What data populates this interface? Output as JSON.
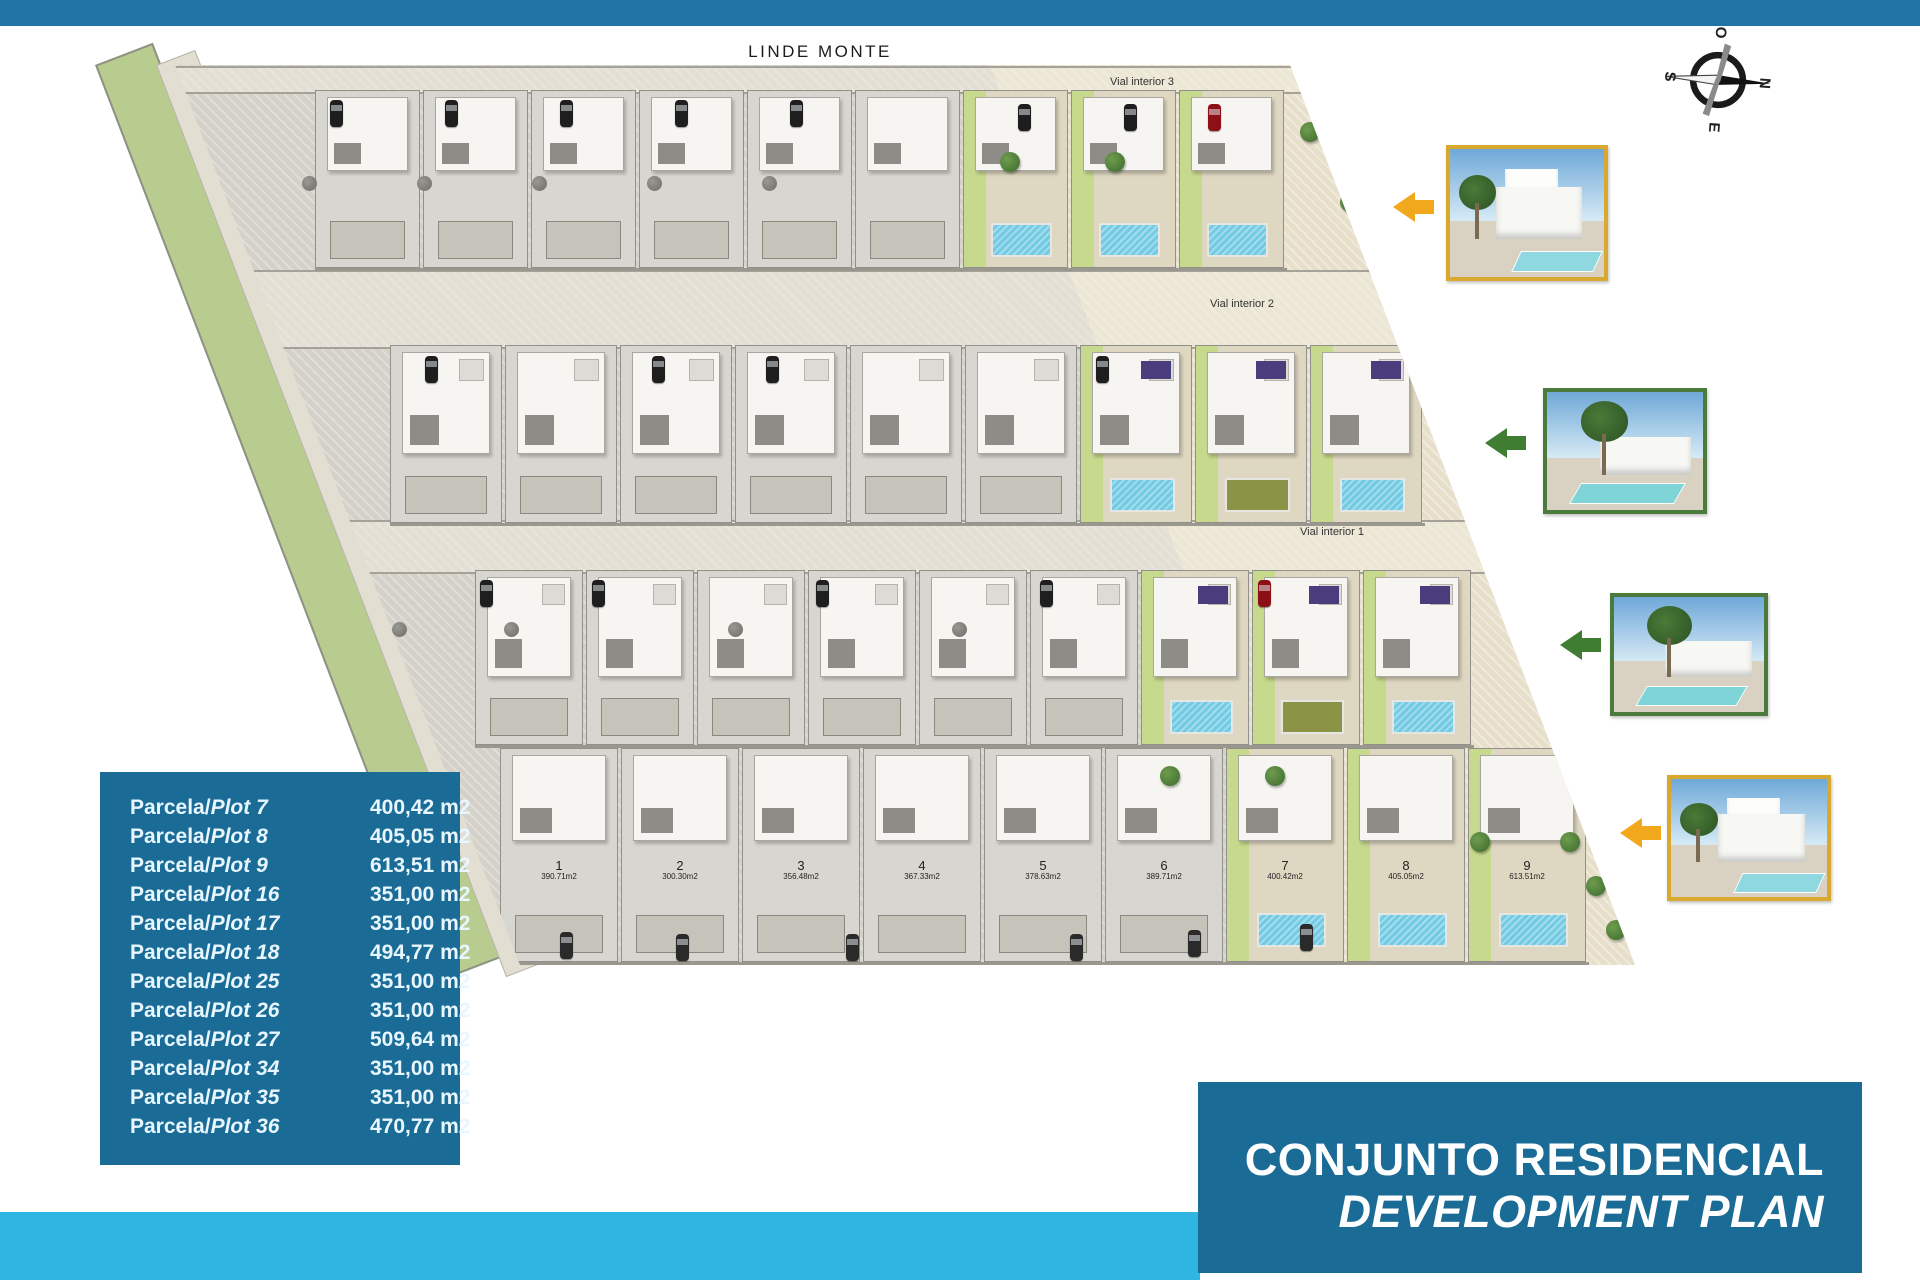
{
  "street_label": "LINDE MONTE",
  "compass": {
    "n": "N",
    "e": "E",
    "s": "S",
    "o": "O"
  },
  "title_block": {
    "line1": "CONJUNTO RESIDENCIAL",
    "line2": "DEVELOPMENT PLAN"
  },
  "colors": {
    "top_bar": "#2172a5",
    "cyan_bar": "#2eb5e2",
    "title_box": "#1a6b96",
    "legend_box": "#1a6b96",
    "parcel_gray": "#d4d1c9",
    "parcel_cream": "#e7dfca",
    "green_verge": "#b9cc90",
    "lawn_green": "#c7d98d",
    "pool_blue": "#72cbe3",
    "olive_lawn": "#8a9346",
    "solar_panel_purple": "#4a3d7e",
    "photo_frame_gold": "#d9a82e",
    "photo_frame_green": "#4b7a3d",
    "arrow_orange": "#f2a81d",
    "arrow_green": "#3f7d33",
    "car_red": "#8d1016",
    "car_black": "#1e1e1e"
  },
  "plan": {
    "roads": [
      {
        "label": "Vial interior 3"
      },
      {
        "label": "Vial interior 2"
      },
      {
        "label": "Vial interior 1"
      }
    ],
    "rows": [
      {
        "plots": [
          {
            "num": "28",
            "area": "371.97m2",
            "hi": false
          },
          {
            "num": "29",
            "area": "351.00m2",
            "hi": false
          },
          {
            "num": "30",
            "area": "351.00m2",
            "hi": false
          },
          {
            "num": "31",
            "area": "351.00m2",
            "hi": false
          },
          {
            "num": "32",
            "area": "351.00m2",
            "hi": false
          },
          {
            "num": "33",
            "area": "351.00m2",
            "hi": false
          },
          {
            "num": "34",
            "area": "351.00m2",
            "hi": true,
            "feature": "pool"
          },
          {
            "num": "35",
            "area": "351.00m2",
            "hi": true,
            "feature": "pool"
          },
          {
            "num": "36",
            "area": "470.77m2",
            "hi": true,
            "feature": "pool"
          }
        ]
      },
      {
        "plots": [
          {
            "num": "19",
            "area": "345.38m2",
            "hi": false
          },
          {
            "num": "20",
            "area": "351.00m2",
            "hi": false
          },
          {
            "num": "21",
            "area": "351.00m2",
            "hi": false
          },
          {
            "num": "22",
            "area": "351.00m2",
            "hi": false
          },
          {
            "num": "23",
            "area": "351.00m2",
            "hi": false
          },
          {
            "num": "24",
            "area": "351.00m2",
            "hi": false
          },
          {
            "num": "25",
            "area": "351.00m2",
            "hi": true,
            "feature": "pool"
          },
          {
            "num": "26",
            "area": "351.00m2",
            "hi": true,
            "feature": "olive"
          },
          {
            "num": "27",
            "area": "509.64m2",
            "hi": true,
            "feature": "pool"
          }
        ]
      },
      {
        "plots": [
          {
            "num": "10",
            "area": "349.69m2",
            "hi": false
          },
          {
            "num": "11",
            "area": "351.00m2",
            "hi": false
          },
          {
            "num": "12",
            "area": "351.00m2",
            "hi": false
          },
          {
            "num": "13",
            "area": "351.00m2",
            "hi": false
          },
          {
            "num": "14",
            "area": "351.00m2",
            "hi": false
          },
          {
            "num": "15",
            "area": "351.00m2",
            "hi": false
          },
          {
            "num": "16",
            "area": "351.00m2",
            "hi": true,
            "feature": "pool"
          },
          {
            "num": "17",
            "area": "351.00m2",
            "hi": true,
            "feature": "olive"
          },
          {
            "num": "18",
            "area": "494.77m2",
            "hi": true,
            "feature": "pool"
          }
        ]
      },
      {
        "plots": [
          {
            "num": "1",
            "area": "390.71m2",
            "hi": false
          },
          {
            "num": "2",
            "area": "300.30m2",
            "hi": false
          },
          {
            "num": "3",
            "area": "356.48m2",
            "hi": false
          },
          {
            "num": "4",
            "area": "367.33m2",
            "hi": false
          },
          {
            "num": "5",
            "area": "378.63m2",
            "hi": false
          },
          {
            "num": "6",
            "area": "389.71m2",
            "hi": false
          },
          {
            "num": "7",
            "area": "400.42m2",
            "hi": true,
            "feature": "pool"
          },
          {
            "num": "8",
            "area": "405.05m2",
            "hi": true,
            "feature": "pool"
          },
          {
            "num": "9",
            "area": "613.51m2",
            "hi": true,
            "feature": "pool"
          }
        ]
      }
    ],
    "decor": {
      "cars": [
        [
          240,
          40,
          "#1e1e1e"
        ],
        [
          355,
          40,
          "#1e1e1e"
        ],
        [
          470,
          40,
          "#1e1e1e"
        ],
        [
          585,
          40,
          "#1e1e1e"
        ],
        [
          700,
          40,
          "#1e1e1e"
        ],
        [
          928,
          44,
          "#1e1e1e"
        ],
        [
          1034,
          44,
          "#1e1e1e"
        ],
        [
          1118,
          44,
          "#8d1016"
        ],
        [
          335,
          296,
          "#1e1e1e"
        ],
        [
          562,
          296,
          "#1e1e1e"
        ],
        [
          676,
          296,
          "#1e1e1e"
        ],
        [
          1006,
          296,
          "#1e1e1e"
        ],
        [
          390,
          520,
          "#1e1e1e"
        ],
        [
          502,
          520,
          "#1e1e1e"
        ],
        [
          726,
          520,
          "#1e1e1e"
        ],
        [
          950,
          520,
          "#1e1e1e"
        ],
        [
          1168,
          520,
          "#8d1016"
        ],
        [
          470,
          872,
          "#2a2a2a"
        ],
        [
          586,
          874,
          "#2a2a2a"
        ],
        [
          756,
          874,
          "#2a2a2a"
        ],
        [
          980,
          874,
          "#2a2a2a"
        ],
        [
          1098,
          870,
          "#2a2a2a"
        ],
        [
          1210,
          864,
          "#2a2a2a"
        ]
      ],
      "trees": [
        [
          910,
          92
        ],
        [
          1015,
          92
        ],
        [
          1210,
          62
        ],
        [
          1250,
          132
        ],
        [
          1278,
          196
        ],
        [
          1325,
          312
        ],
        [
          1360,
          382
        ],
        [
          1392,
          452
        ],
        [
          1412,
          542
        ],
        [
          1442,
          612
        ],
        [
          1070,
          706
        ],
        [
          1175,
          706
        ],
        [
          1380,
          772
        ],
        [
          1470,
          772
        ],
        [
          1496,
          816
        ],
        [
          1516,
          860
        ]
      ],
      "bushes": [
        [
          212,
          116
        ],
        [
          327,
          116
        ],
        [
          442,
          116
        ],
        [
          557,
          116
        ],
        [
          672,
          116
        ],
        [
          302,
          562
        ],
        [
          414,
          562
        ],
        [
          638,
          562
        ],
        [
          862,
          562
        ]
      ]
    }
  },
  "photos": [
    {
      "frame": "#d9a82e",
      "arrow": "#f2a81d",
      "type": "A"
    },
    {
      "frame": "#4b7a3d",
      "arrow": "#3f7d33",
      "type": "B"
    },
    {
      "frame": "#4b7a3d",
      "arrow": "#3f7d33",
      "type": "B"
    },
    {
      "frame": "#d9a82e",
      "arrow": "#f2a81d",
      "type": "A"
    }
  ],
  "legend": {
    "rows": [
      {
        "prefix": "Parcela/",
        "plot": "Plot 7",
        "value": "400,42 m2"
      },
      {
        "prefix": "Parcela/",
        "plot": "Plot 8",
        "value": "405,05 m2"
      },
      {
        "prefix": "Parcela/",
        "plot": "Plot 9",
        "value": "613,51 m2"
      },
      {
        "prefix": "Parcela/",
        "plot": "Plot 16",
        "value": "351,00 m2"
      },
      {
        "prefix": "Parcela/",
        "plot": "Plot 17",
        "value": "351,00 m2"
      },
      {
        "prefix": "Parcela/",
        "plot": "Plot 18",
        "value": "494,77 m2"
      },
      {
        "prefix": "Parcela/",
        "plot": "Plot 25",
        "value": "351,00 m2"
      },
      {
        "prefix": "Parcela/",
        "plot": "Plot 26",
        "value": "351,00 m2"
      },
      {
        "prefix": "Parcela/",
        "plot": "Plot 27",
        "value": "509,64 m2"
      },
      {
        "prefix": "Parcela/",
        "plot": "Plot 34",
        "value": "351,00 m2"
      },
      {
        "prefix": "Parcela/",
        "plot": "Plot 35",
        "value": "351,00 m2"
      },
      {
        "prefix": "Parcela/",
        "plot": "Plot 36",
        "value": "470,77 m2"
      }
    ]
  }
}
